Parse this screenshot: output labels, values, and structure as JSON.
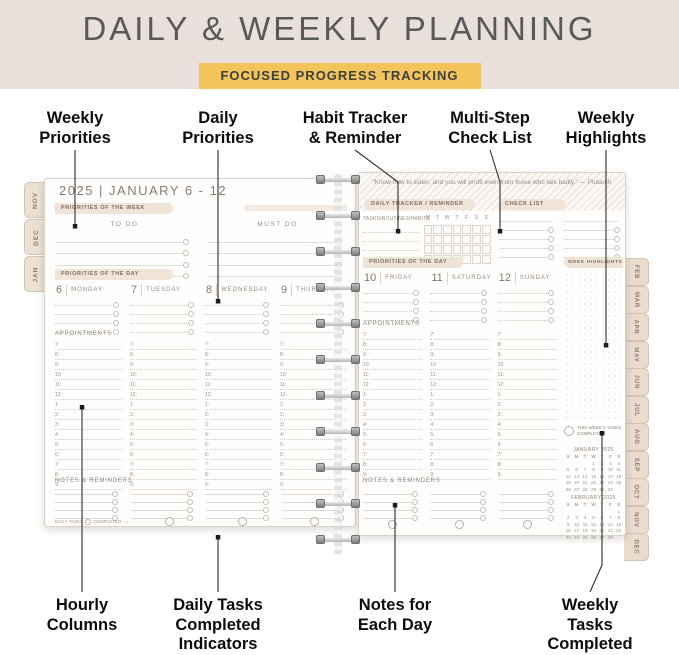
{
  "header": {
    "title": "DAILY & WEEKLY PLANNING",
    "badge": "FOCUSED PROGRESS TRACKING"
  },
  "annotations": {
    "top": [
      {
        "label": "Weekly\nPriorities"
      },
      {
        "label": "Daily\nPriorities"
      },
      {
        "label": "Habit Tracker\n& Reminder"
      },
      {
        "label": "Multi-Step\nCheck List"
      },
      {
        "label": "Weekly\nHighlights"
      }
    ],
    "bottom": [
      {
        "label": "Hourly\nColumns"
      },
      {
        "label": "Daily Tasks\nCompleted\nIndicators"
      },
      {
        "label": "Notes for\nEach Day"
      },
      {
        "label": "Weekly Tasks\nCompleted\nCheck Box"
      }
    ]
  },
  "left_page": {
    "title": "2025 | JANUARY 6 - 12",
    "priorities_week_label": "PRIORITIES OF THE WEEK",
    "todo_headers": [
      "TO DO",
      "MUST DO"
    ],
    "priorities_day_label": "PRIORITIES OF THE DAY",
    "days": [
      {
        "num": "6",
        "name": "MONDAY"
      },
      {
        "num": "7",
        "name": "TUESDAY"
      },
      {
        "num": "8",
        "name": "WEDNESDAY"
      },
      {
        "num": "9",
        "name": "THURSDAY"
      }
    ],
    "appointments_label": "APPOINTMENTS",
    "hours": [
      "7:",
      "8:",
      "9:",
      "10:",
      "11:",
      "12:",
      "1:",
      "2:",
      "3:",
      "4:",
      "5:",
      "6:",
      "7:",
      "8:",
      "9:"
    ],
    "notes_label": "NOTES & REMINDERS",
    "completed_row": {
      "daily_tasks": "DAILY TASKS",
      "completed": "COMPLETED"
    }
  },
  "right_page": {
    "quote": "“Know how to listen, and you will profit even from those who talk badly.” — Plutarch",
    "daily_tracker_label": "DAILY TRACKER / REMINDER",
    "tasks_label": "TASKS/ROUTINES/HABITS",
    "tracker_days": [
      "M",
      "T",
      "W",
      "T",
      "F",
      "S",
      "S"
    ],
    "check_list_label": "CHECK LIST",
    "priorities_day_label": "PRIORITIES OF THE DAY",
    "week_highlights_label": "WEEK HIGHLIGHTS",
    "days": [
      {
        "num": "10",
        "name": "FRIDAY"
      },
      {
        "num": "11",
        "name": "SATURDAY"
      },
      {
        "num": "12",
        "name": "SUNDAY"
      }
    ],
    "appointments_label": "APPOINTMENTS",
    "hours": [
      "7:",
      "8:",
      "9:",
      "10:",
      "11:",
      "12:",
      "1:",
      "2:",
      "3:",
      "4:",
      "5:",
      "6:",
      "7:",
      "8:",
      "9:"
    ],
    "notes_label": "NOTES & REMINDERS",
    "weekly_checkbox_label": "THIS WEEK'S TASKS\nCOMPLETED",
    "calendars": [
      {
        "title": "JANUARY 2025",
        "dow": [
          "S",
          "M",
          "T",
          "W",
          "T",
          "F",
          "S"
        ],
        "rows": [
          [
            "",
            "",
            "",
            "1",
            "2",
            "3",
            "4"
          ],
          [
            "5",
            "6",
            "7",
            "8",
            "9",
            "10",
            "11"
          ],
          [
            "12",
            "13",
            "14",
            "15",
            "16",
            "17",
            "18"
          ],
          [
            "19",
            "20",
            "21",
            "22",
            "23",
            "24",
            "25"
          ],
          [
            "26",
            "27",
            "28",
            "29",
            "30",
            "31",
            ""
          ]
        ]
      },
      {
        "title": "FEBRUARY 2025",
        "dow": [
          "S",
          "M",
          "T",
          "W",
          "T",
          "F",
          "S"
        ],
        "rows": [
          [
            "",
            "",
            "",
            "",
            "",
            "",
            "1"
          ],
          [
            "2",
            "3",
            "4",
            "5",
            "6",
            "7",
            "8"
          ],
          [
            "9",
            "10",
            "11",
            "12",
            "13",
            "14",
            "15"
          ],
          [
            "16",
            "17",
            "18",
            "19",
            "20",
            "21",
            "22"
          ],
          [
            "23",
            "24",
            "25",
            "26",
            "27",
            "28",
            ""
          ]
        ]
      }
    ]
  },
  "tabs": {
    "left": [
      "NOV",
      "DEC",
      "JAN"
    ],
    "right": [
      "FEB",
      "MAR",
      "APR",
      "MAY",
      "JUN",
      "JUL",
      "AUG",
      "SEP",
      "OCT",
      "NOV",
      "DEC"
    ]
  },
  "icons": {
    "completed_arrow": "→"
  },
  "colors": {
    "band_bg": "#e9e0dc",
    "badge_bg": "#f2c45a",
    "banner_bg": "#f0e3d8",
    "tab_bg": "#e9dccd",
    "title_text": "#595959",
    "planner_text": "#8a8178"
  }
}
